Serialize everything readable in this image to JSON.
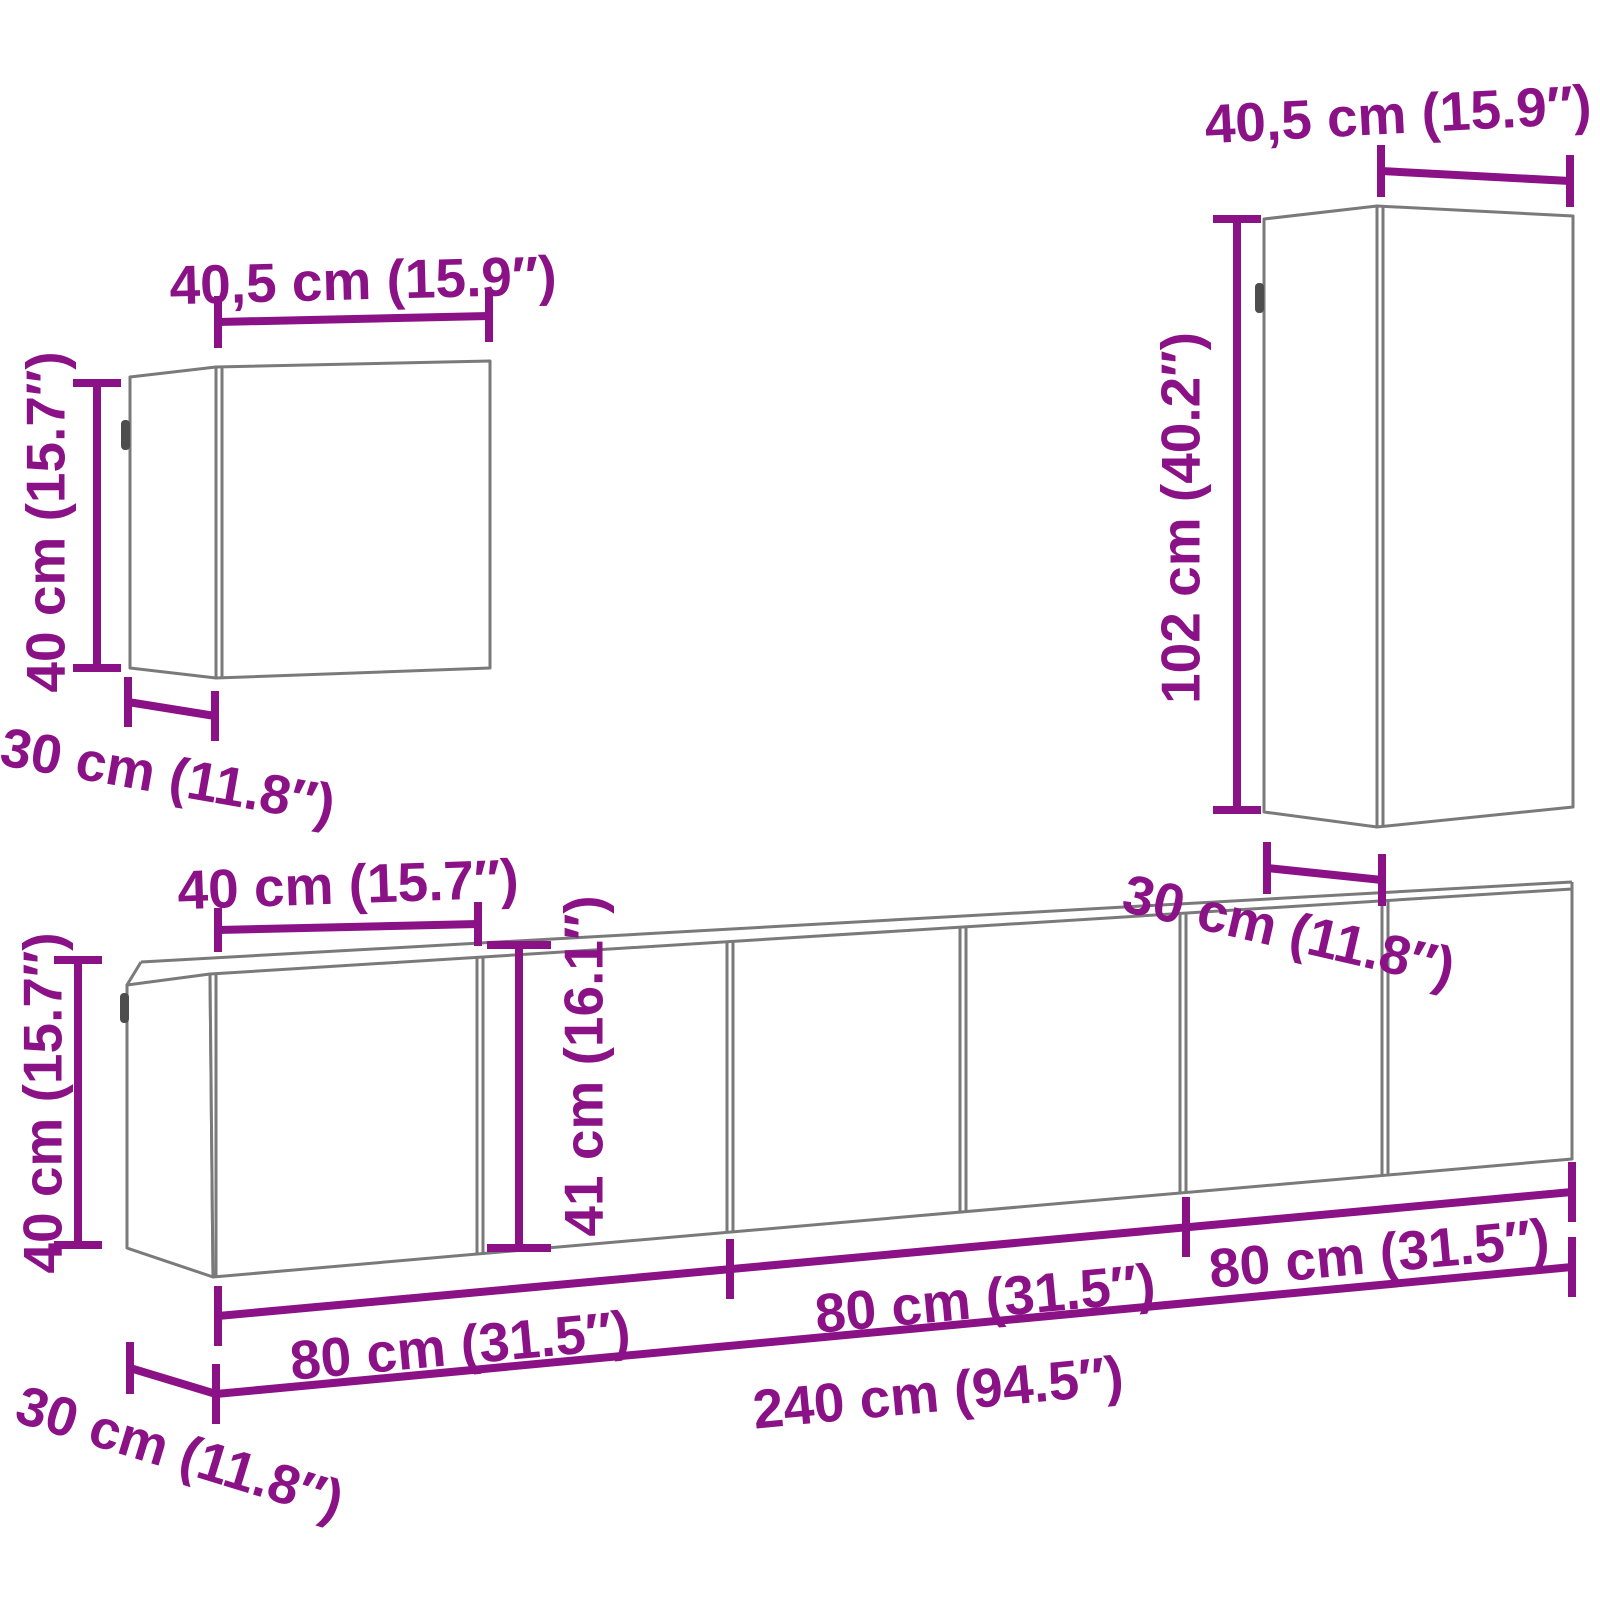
{
  "colors": {
    "accent": "#8B1186",
    "cabinet_line": "#7a7a7a",
    "handle": "#4d4d4d",
    "background": "#ffffff"
  },
  "cabinets": {
    "top_left": {
      "name": "small wall cabinet",
      "width_label": "40,5 cm (15.9″)",
      "height_label": "40 cm (15.7″)",
      "depth_label": "30 cm (11.8″)"
    },
    "top_right": {
      "name": "tall wall cabinet",
      "width_label": "40,5 cm (15.9″)",
      "height_label": "102 cm (40.2″)",
      "depth_label": "30 cm (11.8″)"
    },
    "bottom_row": {
      "name": "tv cabinet row",
      "door_width_label": "40 cm (15.7″)",
      "height_label": "40 cm (15.7″)",
      "unit_height_label": "41 cm (16.1″)",
      "segment_labels": [
        "80 cm (31.5″)",
        "80 cm (31.5″)",
        "80 cm (31.5″)"
      ],
      "total_width_label": "240 cm (94.5″)",
      "depth_label": "30 cm (11.8″)"
    }
  }
}
